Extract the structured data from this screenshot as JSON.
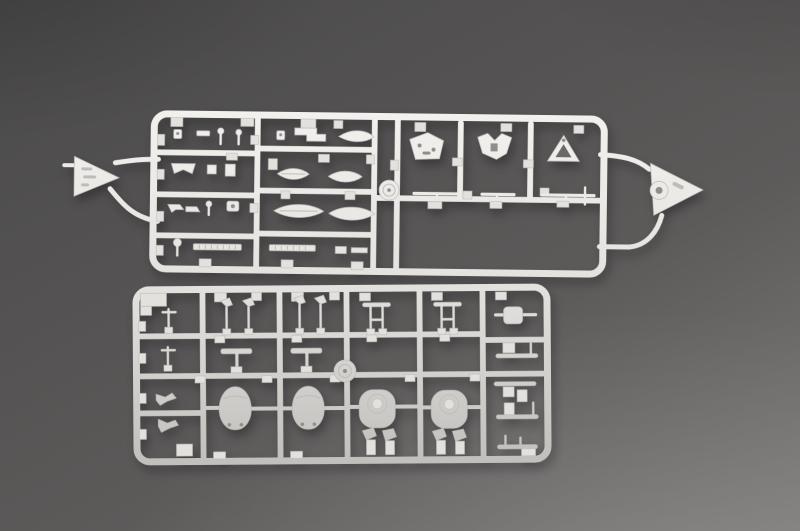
{
  "scene": {
    "type": "product-photograph",
    "description": "Top-down studio photograph of two light-grey injection-moulded plastic model-kit sprues (runner frames with ship detail parts) lying on a neutral grey backdrop, lit softly from the lower right.",
    "objects": [
      {
        "id": "sprue-a",
        "label": "upper sprue",
        "details": "long horizontal runner frame holding small ship fittings: six ship's-boat hulls, gun-platform plates, railing and ladder strips, a round cable reel disc, an empty rectangular bay at lower right, and triangular identification tags attached at both ends"
      },
      {
        "id": "sprue-b",
        "label": "lower sprue",
        "details": "rectangular runner frame holding two teardrop gun-turret housings with twin barrel holes, two round-capped turret housings, a turntable disc, mast and davit pins, anchors and small deck fittings"
      }
    ]
  },
  "colors": {
    "backdrop_top": "#4b4a4a",
    "backdrop_mid": "#5d5b5a",
    "backdrop_bottom": "#7e7c7a",
    "plastic_light": "#f3f2ef",
    "plastic_base": "#e2e1dd",
    "plastic_shade": "#bdbcb8",
    "recess": "#8f8e8a",
    "shadow": "#26262b"
  }
}
